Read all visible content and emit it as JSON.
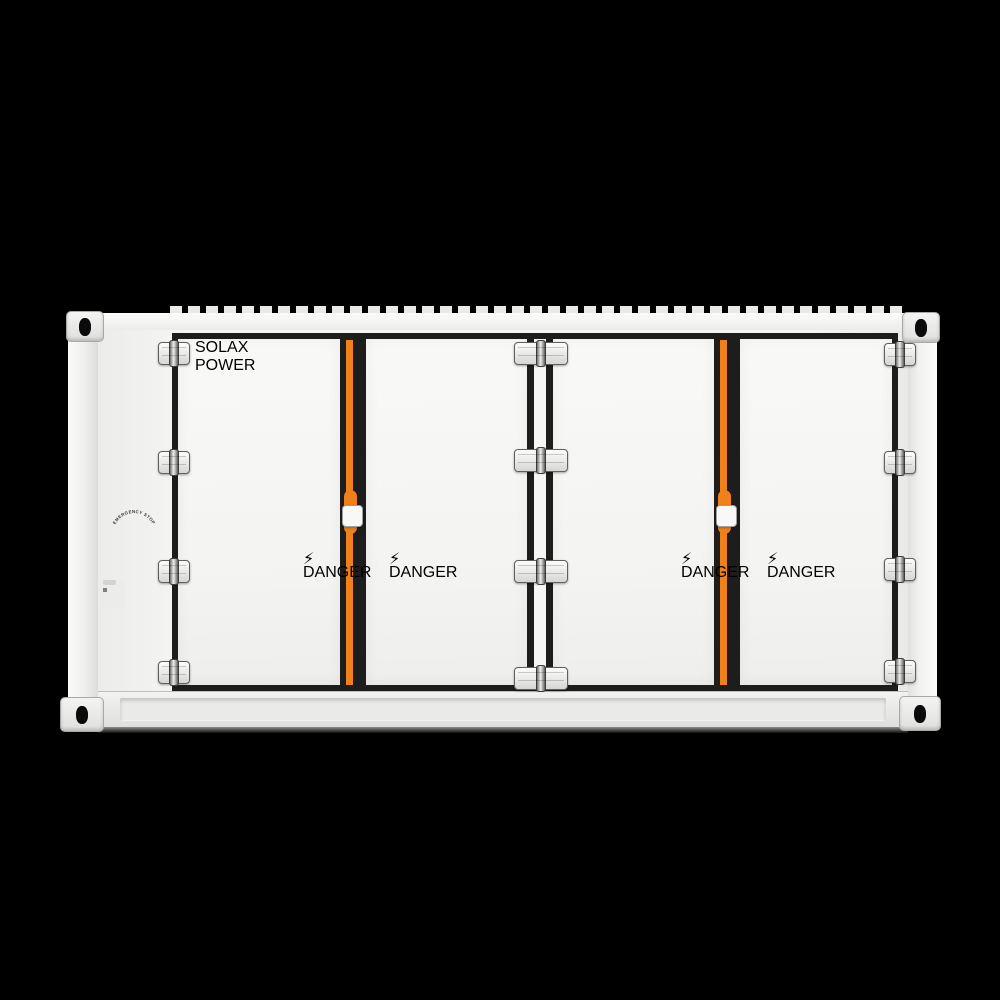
{
  "scene": {
    "background_color": "#000000"
  },
  "equipment": {
    "brand": "SOLAX",
    "brand_subtitle": "POWER",
    "door_count": 4,
    "body_color": "#f5f5f3",
    "frame_color": "#1d1d1d",
    "accent_stripe_color": "#f08019"
  },
  "labels": {
    "emergency_stop": "EMERGENCY STOP",
    "danger": "DANGER"
  },
  "controls": {
    "fire_alarm_panel": {
      "display_color": "#c4282c",
      "red_button_count": 2
    },
    "emergency_stop_button_color": "#cc1111",
    "warning_sticker_count": 4,
    "grounding_point_count": 2
  }
}
